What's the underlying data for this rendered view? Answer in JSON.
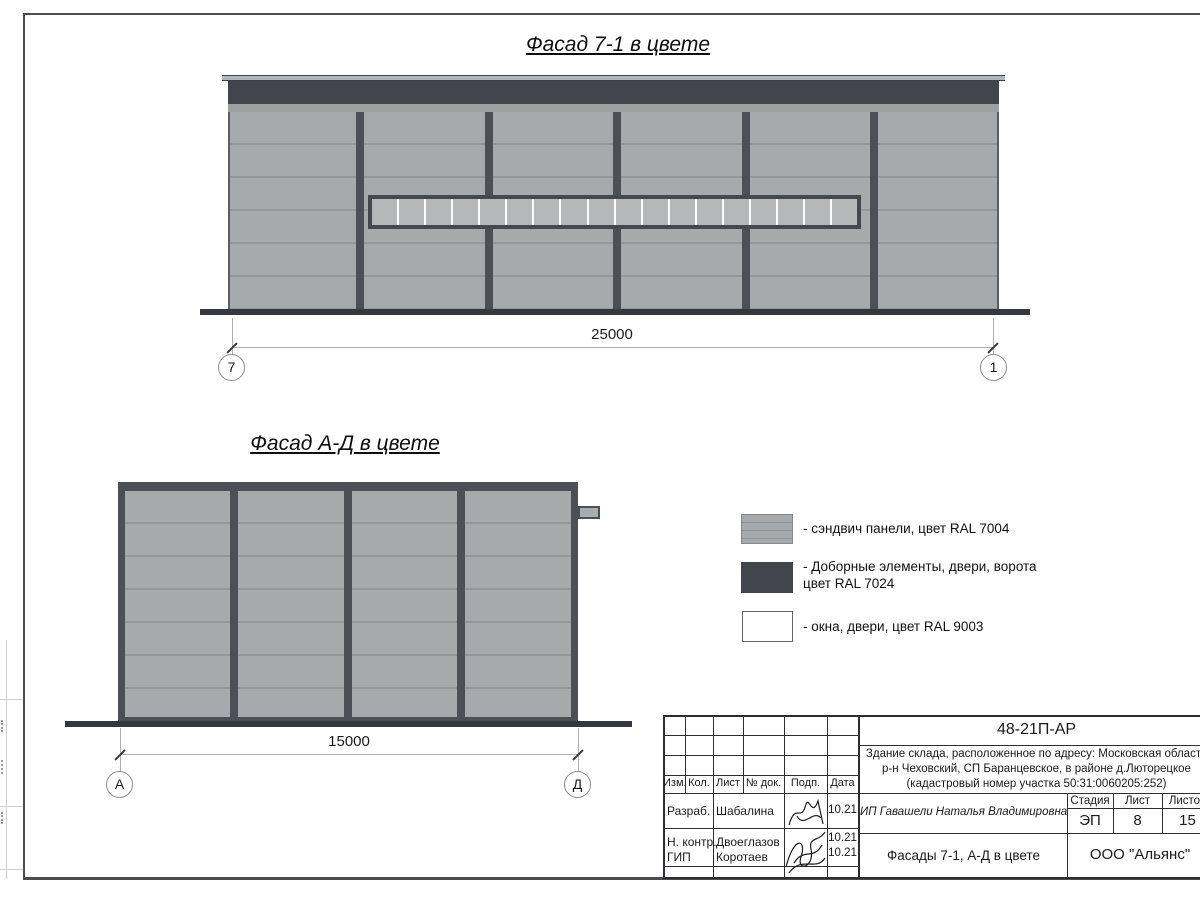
{
  "sheet": {
    "facade1": {
      "title": "Фасад 7-1 в цвете",
      "dimension": "25000",
      "axis_left": "7",
      "axis_right": "1",
      "bays": 6,
      "window_panes": 18
    },
    "facade2": {
      "title": "Фасад А-Д в цвете",
      "dimension": "15000",
      "axis_left": "А",
      "axis_right": "Д",
      "bays": 4
    },
    "legend": {
      "items": [
        {
          "label": "- сэндвич панели, цвет RAL 7004",
          "color": "#a7aaac"
        },
        {
          "label_line1": "- Доборные элементы, двери, ворота",
          "label_line2": "цвет RAL 7024",
          "color": "#42464c"
        },
        {
          "label": "- окна, двери, цвет RAL 9003",
          "color": "#ffffff"
        }
      ]
    },
    "title_block": {
      "doc_number": "48-21П-АР",
      "address_line1": "Здание склада, расположенное по адресу: Московская область",
      "address_line2": "р-н Чеховский, СП Баранцевское, в районе д.Люторецкое",
      "address_line3": "(кадастровый номер участка 50:31:0060205:252)",
      "rev_headers": [
        "Изм.",
        "Кол.",
        "Лист",
        "№ док.",
        "Подп.",
        "Дата"
      ],
      "signature_rows": [
        {
          "role": "Разраб.",
          "name": "Шабалина",
          "date": "10.21"
        },
        {
          "role": "Н. контр.",
          "name": "Двоеглазов",
          "date": "10.21"
        },
        {
          "role": "ГИП",
          "name": "Коротаев",
          "date": "10.21"
        }
      ],
      "client": "ИП Гавашели Наталья Владимировна",
      "stage_label": "Стадия",
      "stage": "ЭП",
      "sheet_label": "Лист",
      "sheet_no": "8",
      "sheets_label": "Листов",
      "sheets_total": "15",
      "drawing_title": "Фасады 7-1, А-Д в цвете",
      "company": "ООО \"Альянс\""
    },
    "colors": {
      "panel": "#a7aaac",
      "panel_seam": "#94979a",
      "dark_trim": "#42464c",
      "window_pane": "#b5b7b9",
      "window_frame_white": "#ffffff"
    }
  }
}
